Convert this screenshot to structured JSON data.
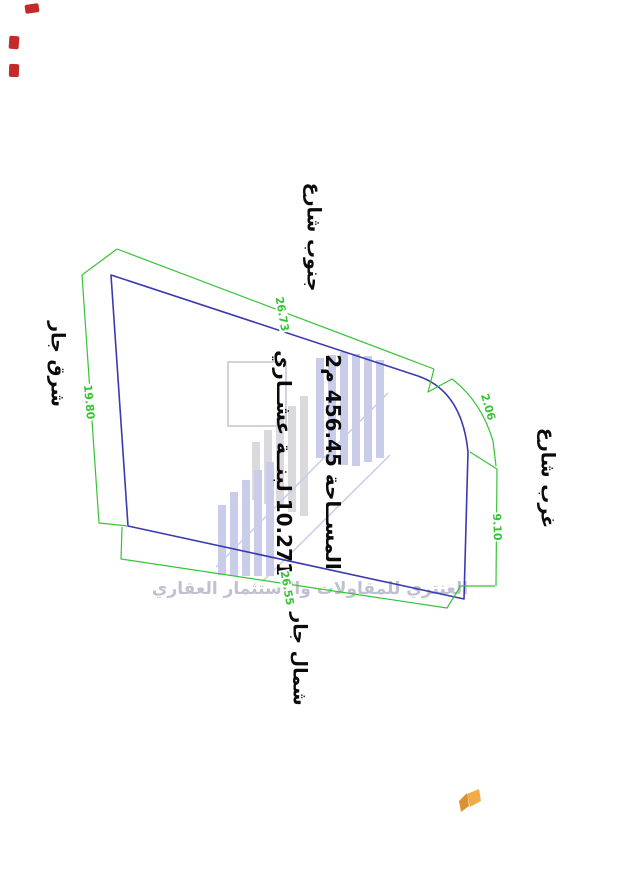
{
  "parcel": {
    "area_label": "المســاحة 456.45 م2",
    "unit_label": "10.271 لبنــة عشــاري",
    "boundaries": {
      "south": "جنوب شارع",
      "east": "شرق جار",
      "west": "غرب شارع",
      "north": "شمال جار"
    },
    "dimensions": {
      "south_edge": "26.73",
      "east_edge": "19.80",
      "corner_arc": "2.06",
      "west_edge": "9.10",
      "north_edge": "26.55"
    },
    "colors": {
      "boundary": "#3A3AB0",
      "dimension": "#35C435",
      "label": "#0B0B0B"
    }
  },
  "watermark": {
    "company": "العنتري للمقاولات والاستثمار العقاري",
    "text_color": "#B9BACB",
    "logo_bar_blue": "#C9CDE9",
    "logo_bar_gray": "#D9D9DE"
  },
  "stamps": {
    "color": "#C01818"
  },
  "brand": {
    "icon": "butterfly-icon",
    "wing_left": "#D8922F",
    "wing_right": "#F0AC49"
  }
}
